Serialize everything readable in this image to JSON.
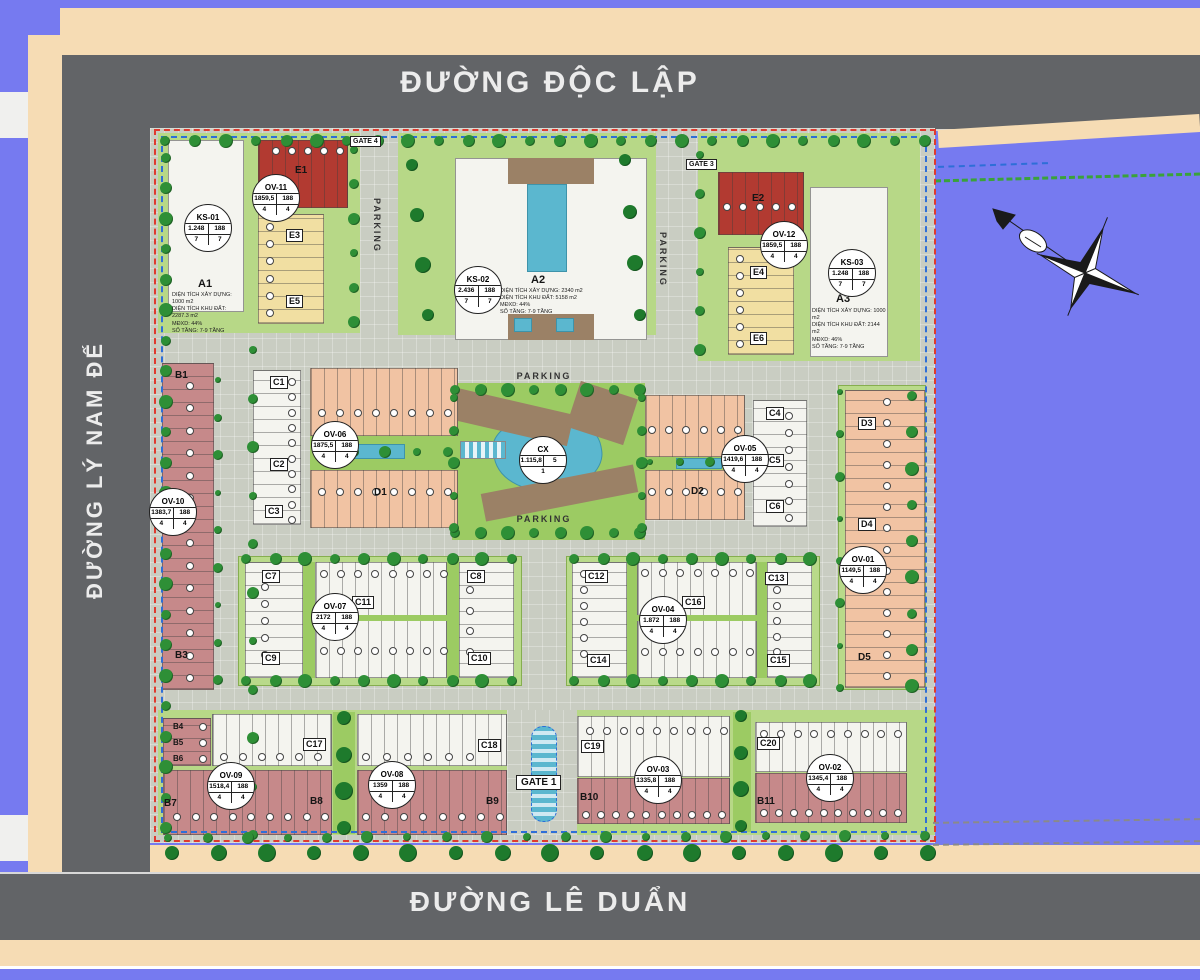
{
  "streets": {
    "top": "ĐƯỜNG ĐỘC LẬP",
    "left": "ĐƯỜNG LÝ NAM ĐẾ",
    "bottom": "ĐƯỜNG LÊ DUẨN"
  },
  "labels": {
    "parking": "PARKING",
    "gate1": "GATE 1",
    "gate3": "GATE 3",
    "gate4": "GATE 4"
  },
  "blocks": {
    "a1": "A1",
    "a2": "A2",
    "a3": "A3",
    "b1": "B1",
    "b3": "B3",
    "b4": "B4",
    "b5": "B5",
    "b6": "B6",
    "b7": "B7",
    "b8": "B8",
    "b9": "B9",
    "b10": "B10",
    "b11": "B11",
    "c1": "C1",
    "c2": "C2",
    "c3": "C3",
    "c4": "C4",
    "c5": "C5",
    "c6": "C6",
    "c7": "C7",
    "c8": "C8",
    "c9": "C9",
    "c10": "C10",
    "c11": "C11",
    "c12": "C12",
    "c13": "C13",
    "c14": "C14",
    "c15": "C15",
    "c16": "C16",
    "c17": "C17",
    "c18": "C18",
    "c19": "C19",
    "c20": "C20",
    "d1": "D1",
    "d2": "D2",
    "d3": "D3",
    "d4": "D4",
    "d5": "D5",
    "e1": "E1",
    "e2": "E2",
    "e3": "E3",
    "e4": "E4",
    "e5": "E5",
    "e6": "E6"
  },
  "building_info": {
    "a1": [
      "DIỆN TÍCH XÂY DỰNG: 1000 m2",
      "DIỆN TÍCH KHU ĐẤT: 2287.3 m2",
      "MĐXD: 44%",
      "SỐ TẦNG: 7-9 TẦNG"
    ],
    "a2": [
      "DIỆN TÍCH XÂY DỰNG: 2340 m2",
      "DIỆN TÍCH KHU ĐẤT: 5158 m2",
      "MĐXD: 44%",
      "SỐ TẦNG: 7-9 TẦNG"
    ],
    "a3": [
      "DIỆN TÍCH XÂY DỰNG: 1000 m2",
      "DIỆN TÍCH KHU ĐẤT: 2144 m2",
      "MĐXD: 46%",
      "SỐ TẦNG: 7-9 TẦNG"
    ]
  },
  "badges": [
    {
      "id": "ks01",
      "name": "KS-01",
      "a": "1.248",
      "b": "188",
      "c": "7",
      "d": "7"
    },
    {
      "id": "ov11",
      "name": "OV-11",
      "a": "1859,5",
      "b": "188",
      "c": "4",
      "d": "4"
    },
    {
      "id": "ks02",
      "name": "KS-02",
      "a": "2.436",
      "b": "188",
      "c": "7",
      "d": "7"
    },
    {
      "id": "ov12",
      "name": "OV-12",
      "a": "1859,5",
      "b": "188",
      "c": "4",
      "d": "4"
    },
    {
      "id": "ks03",
      "name": "KS-03",
      "a": "1.248",
      "b": "188",
      "c": "7",
      "d": "7"
    },
    {
      "id": "ov10",
      "name": "OV-10",
      "a": "1383,7",
      "b": "188",
      "c": "4",
      "d": "4"
    },
    {
      "id": "ov06",
      "name": "OV-06",
      "a": "1875,5",
      "b": "188",
      "c": "4",
      "d": "4"
    },
    {
      "id": "cx",
      "name": "CX",
      "a": "1.115,8",
      "b": "5",
      "c": "1",
      "d": null
    },
    {
      "id": "ov05",
      "name": "OV-05",
      "a": "1419,6",
      "b": "188",
      "c": "4",
      "d": "4"
    },
    {
      "id": "ov01",
      "name": "OV-01",
      "a": "1149,5",
      "b": "188",
      "c": "4",
      "d": "4"
    },
    {
      "id": "ov07",
      "name": "OV-07",
      "a": "2172",
      "b": "188",
      "c": "4",
      "d": "4"
    },
    {
      "id": "ov04",
      "name": "OV-04",
      "a": "1.872",
      "b": "188",
      "c": "4",
      "d": "4"
    },
    {
      "id": "ov09",
      "name": "OV-09",
      "a": "1518,4",
      "b": "188",
      "c": "4",
      "d": "4"
    },
    {
      "id": "ov08",
      "name": "OV-08",
      "a": "1359",
      "b": "188",
      "c": "4",
      "d": "4"
    },
    {
      "id": "ov03",
      "name": "OV-03",
      "a": "1335,8",
      "b": "188",
      "c": "4",
      "d": "4"
    },
    {
      "id": "ov02",
      "name": "OV-02",
      "a": "1345,4",
      "b": "188",
      "c": "4",
      "d": "4"
    }
  ],
  "colors": {
    "background": "#767af0",
    "road": "#626467",
    "sidewalk": "#f6dcb4",
    "boundary_red": "#e03a2e",
    "boundary_blue": "#2e6ed8",
    "water": "#5bb7cf",
    "lot_pink": "#c6898a",
    "lot_salmon": "#f1c3a3",
    "lot_yellow": "#f1dfa2",
    "lot_red": "#b23a31"
  }
}
